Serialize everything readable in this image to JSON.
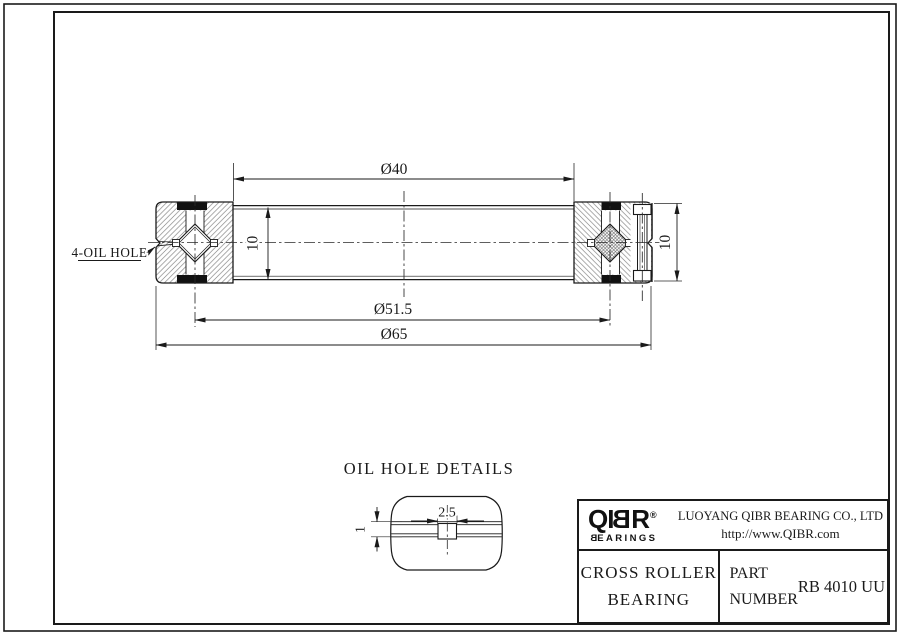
{
  "drawing": {
    "main_view": {
      "oil_hole_label": "4-OIL HOLE",
      "dim_bore": "Ø40",
      "dim_raceway": "Ø51.5",
      "dim_outer_diameter": "Ø65",
      "dim_width_left": "10",
      "dim_width_right": "10"
    },
    "detail_view": {
      "title": "OIL HOLE DETAILS",
      "dim_hole_width": "2.5",
      "dim_groove_depth": "1"
    }
  },
  "title_block": {
    "brand": {
      "name_prefix": "QI",
      "name_mirrored_letter": "B",
      "name_suffix": "R",
      "registered_mark": "®",
      "tagline_mirrored_letter": "B",
      "tagline_rest": "EARINGS"
    },
    "company_name": "LUOYANG QIBR BEARING CO., LTD",
    "website": "http://www.QIBR.com",
    "product": {
      "line1": "CROSS ROLLER",
      "line2": "BEARING"
    },
    "part": {
      "label_line1": "PART",
      "label_line2": "NUMBER",
      "number": "RB 4010 UU"
    }
  },
  "colors": {
    "line": "#1a1a1a",
    "hatch": "#808080",
    "background": "#ffffff"
  }
}
